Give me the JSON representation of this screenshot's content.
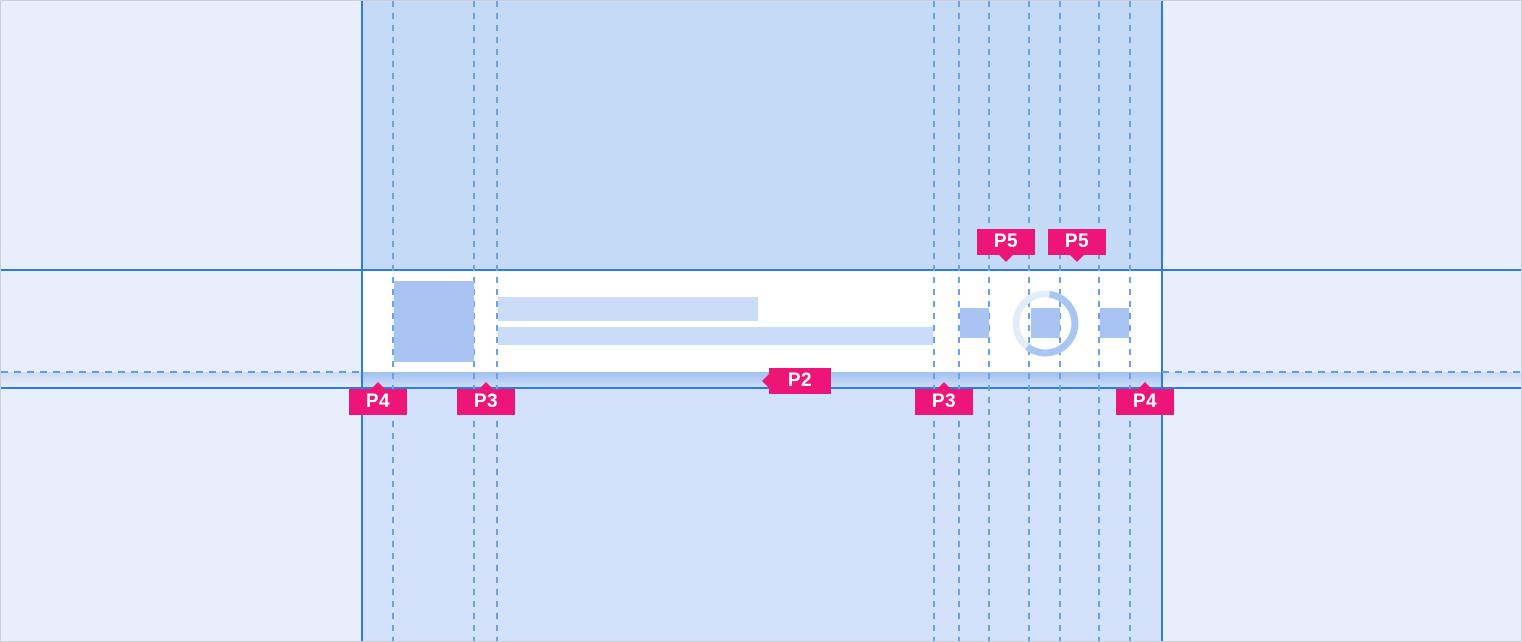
{
  "annotations": {
    "p5_left": {
      "text": "P5"
    },
    "p5_right": {
      "text": "P5"
    },
    "p2": {
      "text": "P2"
    },
    "p4_left": {
      "text": "P4"
    },
    "p3_left": {
      "text": "P3"
    },
    "p3_right": {
      "text": "P3"
    },
    "p4_right": {
      "text": "P4"
    }
  },
  "icons": {
    "spinner": "progress-spinner-ring"
  },
  "colors": {
    "annotation_pink": "#ed1678",
    "guide_solid_blue": "#2d7be4",
    "guide_dashed_blue": "#6aa2ea",
    "canvas_background": "#e8eefc",
    "band_top": "#c4daf7",
    "band_bottom": "#d3e1fa",
    "card_background": "#ffffff",
    "placeholder_dark": "#a9c4f3",
    "placeholder_light": "#cbdcf8",
    "spacing_strip_gradient_top": "#a0c0ef",
    "ring_track": "#e4ecfb",
    "ring_arc": "#a9c6f3"
  }
}
